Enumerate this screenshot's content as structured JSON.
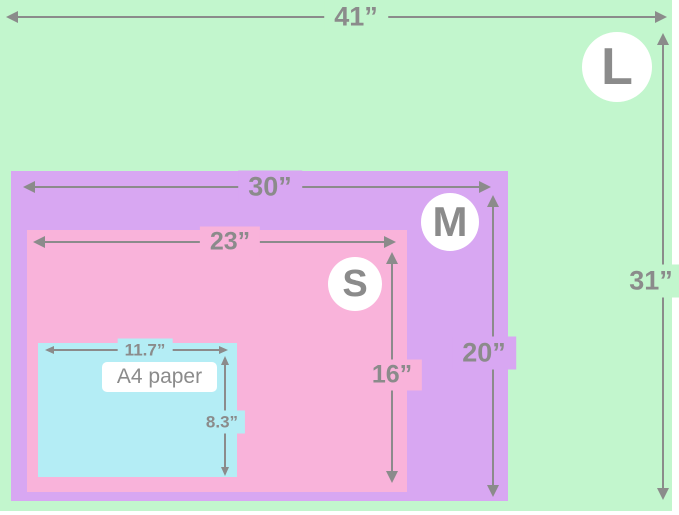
{
  "title": "Blanket size comparison diagram",
  "colors": {
    "green": "#c2f6cd",
    "purple": "#d8a7f2",
    "pink": "#f9b3da",
    "cyan": "#b4edf5",
    "dim": "#8b8b8b",
    "badge_bg": "#ffffff"
  },
  "sizes": {
    "L": {
      "letter": "L",
      "width": "41”",
      "height": "31”"
    },
    "M": {
      "letter": "M",
      "width": "30”",
      "height": "20”"
    },
    "S": {
      "letter": "S",
      "width": "23”",
      "height": "16”"
    },
    "A4": {
      "name": "A4 paper",
      "width": "11.7”",
      "height": "8.3”"
    }
  }
}
